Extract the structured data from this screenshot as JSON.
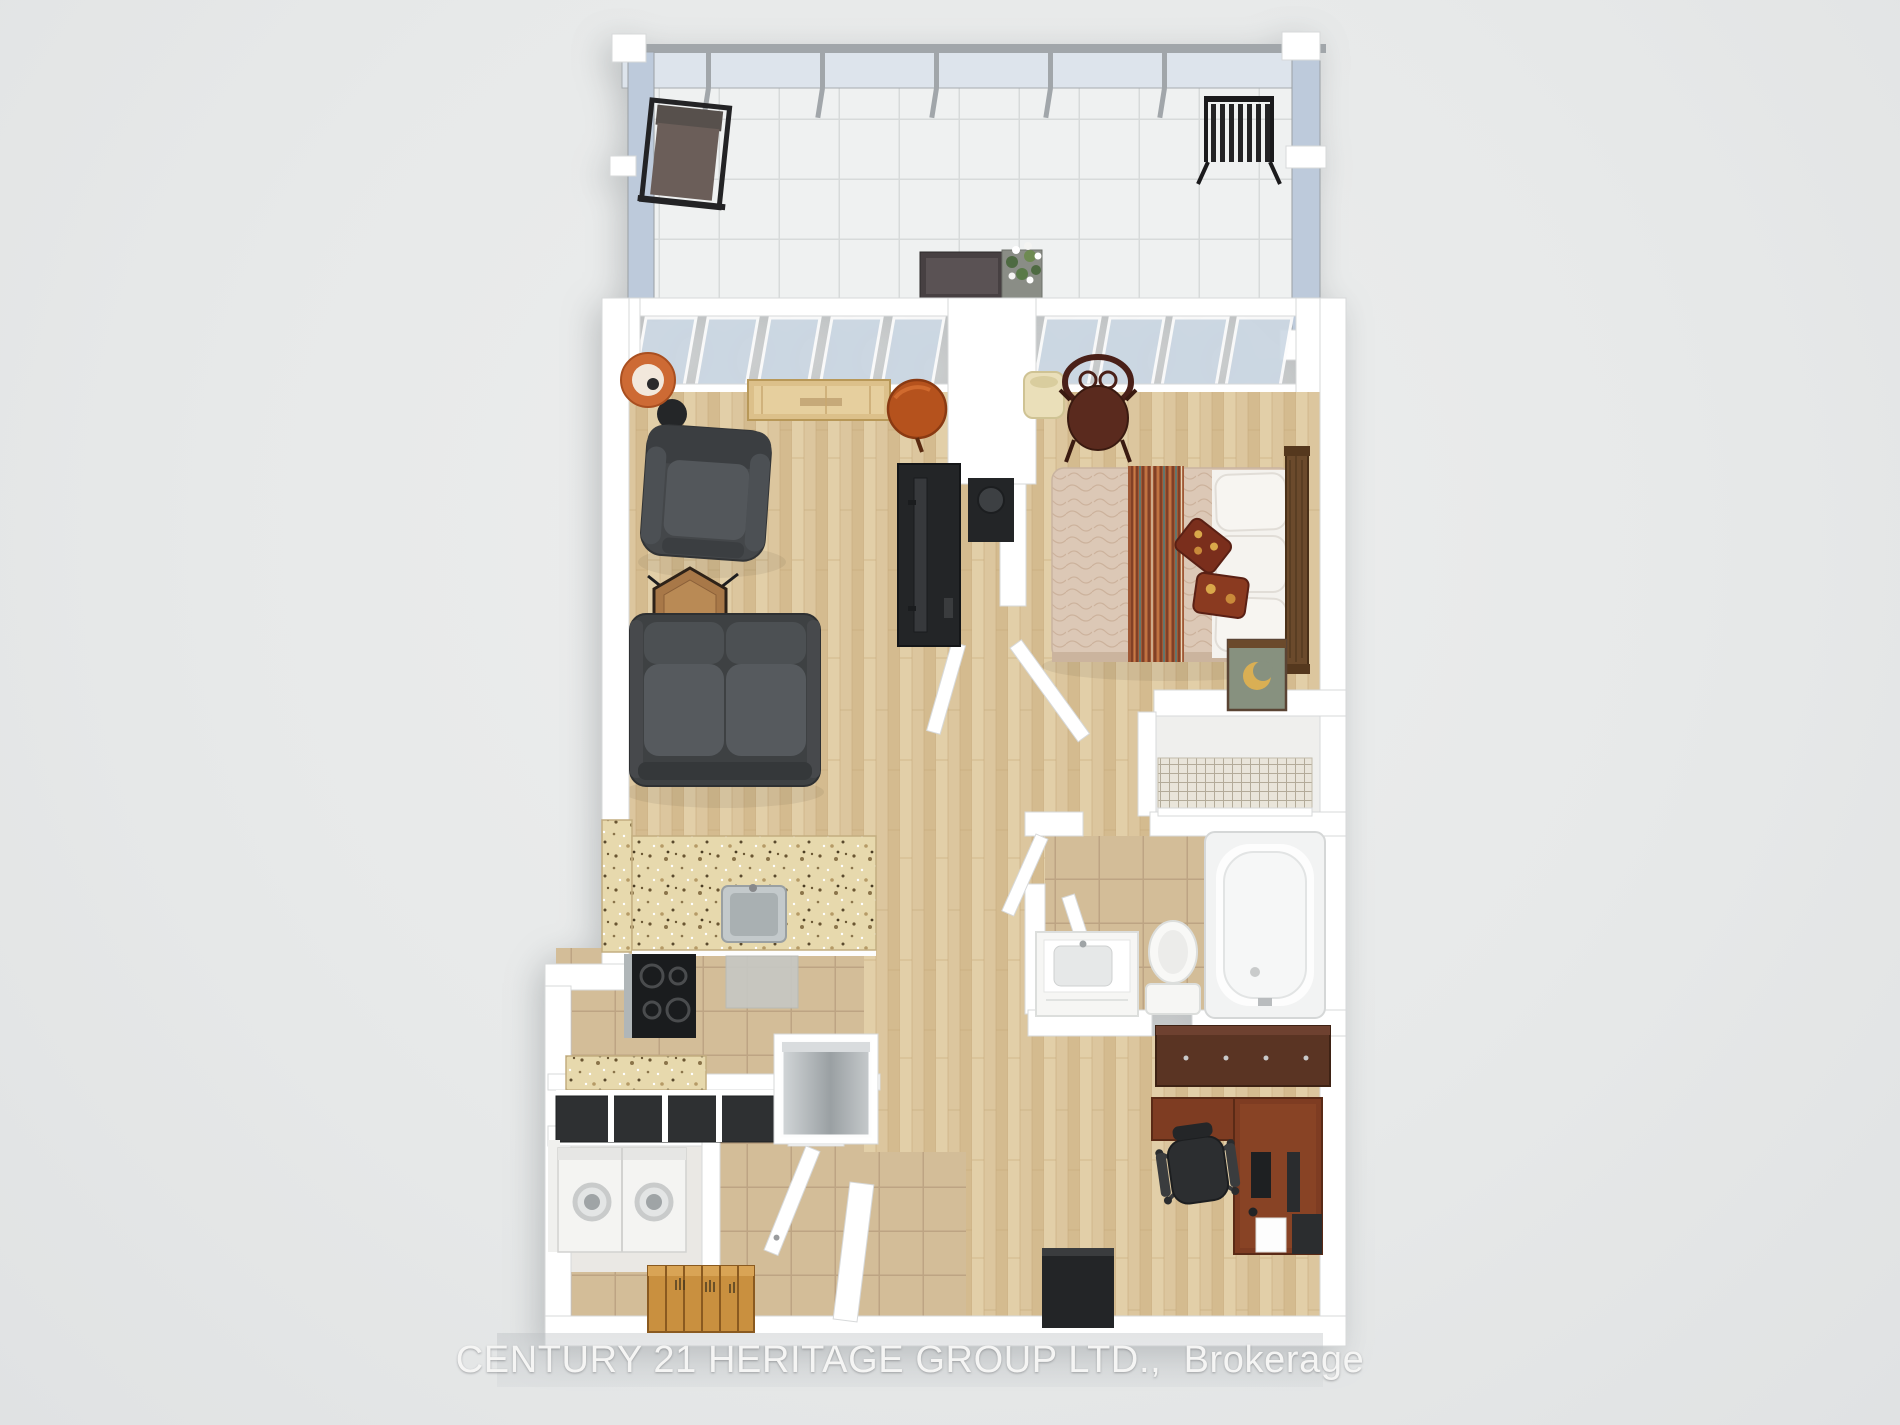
{
  "scene": {
    "kind": "3d-floor-plan-render",
    "view": "top-down one-bedroom apartment with balcony"
  },
  "watermark": {
    "text": "CENTURY 21 HERITAGE GROUP LTD.,  Brokerage"
  },
  "palette": {
    "background": "#e7e9e9",
    "wall": "#ffffff",
    "wall_edge": "#d7d9da",
    "glass": "#c8d3e1",
    "glass_frame": "#a1a6aa",
    "balcony_tile": "#eff1f1",
    "hardwood": "#dcc69e",
    "floor_tile": "#d3bd98",
    "granite_counter": "#e7d9ad",
    "sofa_gray": "#4a4d4f",
    "black_furniture": "#242628",
    "stainless": "#aab0b3",
    "accent_orange": "#c05a28",
    "bed_spread": "#dcc8b6",
    "bed_runner": "#a05835",
    "pillow_white": "#f4f2ee",
    "headboard_wood": "#6b4a2c",
    "nightstand_green": "#87917f",
    "lamp_gold": "#d9af54",
    "desk_mahogany": "#7e3c22",
    "dresser_brown": "#5a3423",
    "entry_bench_wood": "#c9903f",
    "chair_brown": "#58291c",
    "appliance_white": "#f4f4f2"
  },
  "rooms": [
    {
      "id": "balcony",
      "objects": [
        "outdoor-chair",
        "metal-bench",
        "planter-box",
        "planter-flowers",
        "glass-railing"
      ]
    },
    {
      "id": "living-room",
      "objects": [
        "floor-lamp",
        "armchair",
        "hex-side-table",
        "loveseat-sofa",
        "window-bench",
        "round-side-table",
        "tv-console",
        "tv",
        "media-unit"
      ]
    },
    {
      "id": "bedroom",
      "objects": [
        "bentwood-chair",
        "waste-basket",
        "double-bed",
        "striped-runner",
        "pillows",
        "accent-cushions",
        "headboard",
        "nightstand",
        "moon-lamp"
      ]
    },
    {
      "id": "closet",
      "objects": [
        "wire-shelving"
      ]
    },
    {
      "id": "bathroom",
      "objects": [
        "bathtub",
        "toilet",
        "vanity-sink",
        "bifold-door"
      ]
    },
    {
      "id": "kitchen",
      "objects": [
        "granite-peninsula",
        "kitchen-sink",
        "cooktop",
        "floor-mat",
        "granite-counter",
        "black-cabinets",
        "dishwasher"
      ]
    },
    {
      "id": "laundry",
      "objects": [
        "washer",
        "dryer"
      ]
    },
    {
      "id": "entry",
      "objects": [
        "shoe-bench",
        "front-door",
        "storage-cube"
      ]
    },
    {
      "id": "office",
      "objects": [
        "dresser",
        "l-desk",
        "office-chair",
        "monitor",
        "keyboard",
        "paper",
        "pc-tower",
        "storage-cube"
      ]
    }
  ]
}
